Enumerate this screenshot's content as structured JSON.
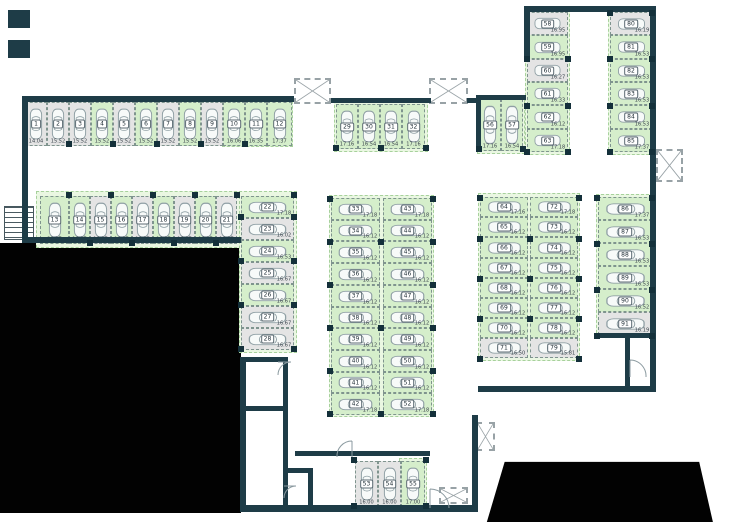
{
  "plan": {
    "name": "underground-parking-floor-plan",
    "stall_states": {
      "green": "highlighted available stall",
      "grey": "plain stall"
    }
  },
  "colors": {
    "wall": "#1e3c47",
    "stall_green": "#d5eecb",
    "stall_grey": "#e4e4e4",
    "zone_green": "#eaf7e2",
    "void": "#020202"
  },
  "stalls": [
    {
      "n": "1",
      "a": "14.04",
      "st": "grey",
      "x": 25,
      "y": 102,
      "w": 22,
      "h": 44,
      "o": "v"
    },
    {
      "n": "2",
      "a": "15.52",
      "st": "grey",
      "x": 47,
      "y": 102,
      "w": 22,
      "h": 44,
      "o": "v"
    },
    {
      "n": "3",
      "a": "15.52",
      "st": "grey",
      "x": 69,
      "y": 102,
      "w": 22,
      "h": 44,
      "o": "v"
    },
    {
      "n": "4",
      "a": "15.52",
      "st": "green",
      "x": 91,
      "y": 102,
      "w": 22,
      "h": 44,
      "o": "v"
    },
    {
      "n": "5",
      "a": "15.52",
      "st": "grey",
      "x": 113,
      "y": 102,
      "w": 22,
      "h": 44,
      "o": "v"
    },
    {
      "n": "6",
      "a": "15.52",
      "st": "green",
      "x": 135,
      "y": 102,
      "w": 22,
      "h": 44,
      "o": "v"
    },
    {
      "n": "7",
      "a": "15.52",
      "st": "grey",
      "x": 157,
      "y": 102,
      "w": 22,
      "h": 44,
      "o": "v"
    },
    {
      "n": "8",
      "a": "15.52",
      "st": "green",
      "x": 179,
      "y": 102,
      "w": 22,
      "h": 44,
      "o": "v"
    },
    {
      "n": "9",
      "a": "15.52",
      "st": "grey",
      "x": 201,
      "y": 102,
      "w": 22,
      "h": 44,
      "o": "v"
    },
    {
      "n": "10",
      "a": "16.06",
      "st": "green",
      "x": 223,
      "y": 102,
      "w": 22,
      "h": 44,
      "o": "v"
    },
    {
      "n": "11",
      "a": "16.35",
      "st": "green",
      "x": 245,
      "y": 102,
      "w": 22,
      "h": 44,
      "o": "v"
    },
    {
      "n": "12",
      "a": "17.37",
      "st": "green",
      "x": 267,
      "y": 102,
      "w": 25,
      "h": 44,
      "o": "v"
    },
    {
      "n": "13",
      "a": "20.27",
      "st": "green",
      "x": 40,
      "y": 196,
      "w": 29,
      "h": 48,
      "o": "v"
    },
    {
      "n": "14",
      "a": "16.87",
      "st": "green",
      "x": 69,
      "y": 196,
      "w": 21,
      "h": 48,
      "o": "v"
    },
    {
      "n": "15",
      "a": "16.87",
      "st": "grey",
      "x": 90,
      "y": 196,
      "w": 21,
      "h": 48,
      "o": "v"
    },
    {
      "n": "16",
      "a": "16.87",
      "st": "green",
      "x": 111,
      "y": 196,
      "w": 21,
      "h": 48,
      "o": "v"
    },
    {
      "n": "17",
      "a": "16.87",
      "st": "grey",
      "x": 132,
      "y": 196,
      "w": 21,
      "h": 48,
      "o": "v"
    },
    {
      "n": "18",
      "a": "16.87",
      "st": "green",
      "x": 153,
      "y": 196,
      "w": 21,
      "h": 48,
      "o": "v"
    },
    {
      "n": "19",
      "a": "16.87",
      "st": "grey",
      "x": 174,
      "y": 196,
      "w": 21,
      "h": 48,
      "o": "v"
    },
    {
      "n": "20",
      "a": "16.87",
      "st": "green",
      "x": 195,
      "y": 196,
      "w": 21,
      "h": 48,
      "o": "v"
    },
    {
      "n": "21",
      "a": "16.87",
      "st": "grey",
      "x": 216,
      "y": 196,
      "w": 21,
      "h": 48,
      "o": "v"
    },
    {
      "n": "22",
      "a": "17.18",
      "st": "green",
      "x": 241,
      "y": 196,
      "w": 53,
      "h": 22,
      "o": "h"
    },
    {
      "n": "23",
      "a": "16.02",
      "st": "grey",
      "x": 241,
      "y": 218,
      "w": 53,
      "h": 22,
      "o": "h"
    },
    {
      "n": "24",
      "a": "16.53",
      "st": "green",
      "x": 241,
      "y": 240,
      "w": 53,
      "h": 22,
      "o": "h"
    },
    {
      "n": "25",
      "a": "16.67",
      "st": "grey",
      "x": 241,
      "y": 262,
      "w": 53,
      "h": 22,
      "o": "h"
    },
    {
      "n": "26",
      "a": "16.67",
      "st": "green",
      "x": 241,
      "y": 284,
      "w": 53,
      "h": 22,
      "o": "h"
    },
    {
      "n": "27",
      "a": "16.67",
      "st": "grey",
      "x": 241,
      "y": 306,
      "w": 53,
      "h": 22,
      "o": "h"
    },
    {
      "n": "28",
      "a": "16.67",
      "st": "grey",
      "x": 241,
      "y": 328,
      "w": 53,
      "h": 22,
      "o": "h"
    },
    {
      "n": "29",
      "a": "17.16",
      "st": "green",
      "x": 336,
      "y": 104,
      "w": 22,
      "h": 45,
      "o": "v"
    },
    {
      "n": "30",
      "a": "16.54",
      "st": "green",
      "x": 358,
      "y": 104,
      "w": 22,
      "h": 45,
      "o": "v"
    },
    {
      "n": "31",
      "a": "16.54",
      "st": "green",
      "x": 380,
      "y": 104,
      "w": 22,
      "h": 45,
      "o": "v"
    },
    {
      "n": "32",
      "a": "17.16",
      "st": "green",
      "x": 402,
      "y": 104,
      "w": 23,
      "h": 45,
      "o": "v"
    },
    {
      "n": "33",
      "a": "17.18",
      "st": "green",
      "x": 331,
      "y": 198,
      "w": 49,
      "h": 22,
      "o": "h"
    },
    {
      "n": "34",
      "a": "16.12",
      "st": "green",
      "x": 331,
      "y": 220,
      "w": 49,
      "h": 21,
      "o": "h"
    },
    {
      "n": "35",
      "a": "16.12",
      "st": "green",
      "x": 331,
      "y": 241,
      "w": 49,
      "h": 22,
      "o": "h"
    },
    {
      "n": "36",
      "a": "16.12",
      "st": "green",
      "x": 331,
      "y": 263,
      "w": 49,
      "h": 22,
      "o": "h"
    },
    {
      "n": "37",
      "a": "16.12",
      "st": "green",
      "x": 331,
      "y": 285,
      "w": 49,
      "h": 22,
      "o": "h"
    },
    {
      "n": "38",
      "a": "16.12",
      "st": "green",
      "x": 331,
      "y": 307,
      "w": 49,
      "h": 21,
      "o": "h"
    },
    {
      "n": "39",
      "a": "16.12",
      "st": "green",
      "x": 331,
      "y": 328,
      "w": 49,
      "h": 22,
      "o": "h"
    },
    {
      "n": "40",
      "a": "16.12",
      "st": "green",
      "x": 331,
      "y": 350,
      "w": 49,
      "h": 22,
      "o": "h"
    },
    {
      "n": "41",
      "a": "16.12",
      "st": "green",
      "x": 331,
      "y": 372,
      "w": 49,
      "h": 21,
      "o": "h"
    },
    {
      "n": "42",
      "a": "17.18",
      "st": "green",
      "x": 331,
      "y": 393,
      "w": 49,
      "h": 22,
      "o": "h"
    },
    {
      "n": "43",
      "a": "17.18",
      "st": "green",
      "x": 383,
      "y": 198,
      "w": 49,
      "h": 22,
      "o": "h"
    },
    {
      "n": "44",
      "a": "16.12",
      "st": "green",
      "x": 383,
      "y": 220,
      "w": 49,
      "h": 21,
      "o": "h"
    },
    {
      "n": "45",
      "a": "16.12",
      "st": "green",
      "x": 383,
      "y": 241,
      "w": 49,
      "h": 22,
      "o": "h"
    },
    {
      "n": "46",
      "a": "16.12",
      "st": "green",
      "x": 383,
      "y": 263,
      "w": 49,
      "h": 22,
      "o": "h"
    },
    {
      "n": "47",
      "a": "16.12",
      "st": "green",
      "x": 383,
      "y": 285,
      "w": 49,
      "h": 22,
      "o": "h"
    },
    {
      "n": "48",
      "a": "16.12",
      "st": "green",
      "x": 383,
      "y": 307,
      "w": 49,
      "h": 21,
      "o": "h"
    },
    {
      "n": "49",
      "a": "16.12",
      "st": "green",
      "x": 383,
      "y": 328,
      "w": 49,
      "h": 22,
      "o": "h"
    },
    {
      "n": "50",
      "a": "16.12",
      "st": "green",
      "x": 383,
      "y": 350,
      "w": 49,
      "h": 22,
      "o": "h"
    },
    {
      "n": "51",
      "a": "16.12",
      "st": "green",
      "x": 383,
      "y": 372,
      "w": 49,
      "h": 21,
      "o": "h"
    },
    {
      "n": "52",
      "a": "17.18",
      "st": "green",
      "x": 383,
      "y": 393,
      "w": 49,
      "h": 22,
      "o": "h"
    },
    {
      "n": "53",
      "a": "16.00",
      "st": "grey",
      "x": 355,
      "y": 461,
      "w": 23,
      "h": 46,
      "o": "v"
    },
    {
      "n": "54",
      "a": "16.00",
      "st": "grey",
      "x": 378,
      "y": 461,
      "w": 23,
      "h": 46,
      "o": "v"
    },
    {
      "n": "55",
      "a": "17.00",
      "st": "green",
      "x": 401,
      "y": 461,
      "w": 24,
      "h": 46,
      "o": "v"
    },
    {
      "n": "56",
      "a": "17.16",
      "st": "green",
      "x": 479,
      "y": 99,
      "w": 22,
      "h": 52,
      "o": "v"
    },
    {
      "n": "57",
      "a": "16.54",
      "st": "green",
      "x": 501,
      "y": 99,
      "w": 22,
      "h": 52,
      "o": "v"
    },
    {
      "n": "58",
      "a": "16.95",
      "st": "grey",
      "x": 527,
      "y": 12,
      "w": 41,
      "h": 23,
      "o": "h"
    },
    {
      "n": "59",
      "a": "16.95",
      "st": "green",
      "x": 527,
      "y": 35,
      "w": 41,
      "h": 24,
      "o": "h"
    },
    {
      "n": "60",
      "a": "16.27",
      "st": "grey",
      "x": 527,
      "y": 59,
      "w": 41,
      "h": 23,
      "o": "h"
    },
    {
      "n": "61",
      "a": "16.33",
      "st": "green",
      "x": 527,
      "y": 82,
      "w": 41,
      "h": 23,
      "o": "h"
    },
    {
      "n": "62",
      "a": "16.12",
      "st": "green",
      "x": 527,
      "y": 105,
      "w": 41,
      "h": 24,
      "o": "h"
    },
    {
      "n": "63",
      "a": "17.18",
      "st": "green",
      "x": 527,
      "y": 129,
      "w": 41,
      "h": 23,
      "o": "h"
    },
    {
      "n": "64",
      "a": "17.16",
      "st": "green",
      "x": 480,
      "y": 197,
      "w": 48,
      "h": 20,
      "o": "h"
    },
    {
      "n": "65",
      "a": "16.12",
      "st": "green",
      "x": 480,
      "y": 217,
      "w": 48,
      "h": 20,
      "o": "h"
    },
    {
      "n": "66",
      "a": "16.12",
      "st": "green",
      "x": 480,
      "y": 237,
      "w": 48,
      "h": 21,
      "o": "h"
    },
    {
      "n": "67",
      "a": "16.12",
      "st": "green",
      "x": 480,
      "y": 258,
      "w": 48,
      "h": 20,
      "o": "h"
    },
    {
      "n": "68",
      "a": "16.12",
      "st": "green",
      "x": 480,
      "y": 278,
      "w": 48,
      "h": 20,
      "o": "h"
    },
    {
      "n": "69",
      "a": "16.12",
      "st": "green",
      "x": 480,
      "y": 298,
      "w": 48,
      "h": 20,
      "o": "h"
    },
    {
      "n": "70",
      "a": "16.12",
      "st": "green",
      "x": 480,
      "y": 318,
      "w": 48,
      "h": 20,
      "o": "h"
    },
    {
      "n": "71",
      "a": "16.50",
      "st": "grey",
      "x": 480,
      "y": 338,
      "w": 48,
      "h": 20,
      "o": "h"
    },
    {
      "n": "72",
      "a": "17.18",
      "st": "green",
      "x": 530,
      "y": 197,
      "w": 48,
      "h": 20,
      "o": "h"
    },
    {
      "n": "73",
      "a": "16.12",
      "st": "green",
      "x": 530,
      "y": 217,
      "w": 48,
      "h": 20,
      "o": "h"
    },
    {
      "n": "74",
      "a": "16.12",
      "st": "green",
      "x": 530,
      "y": 237,
      "w": 48,
      "h": 21,
      "o": "h"
    },
    {
      "n": "75",
      "a": "16.12",
      "st": "green",
      "x": 530,
      "y": 258,
      "w": 48,
      "h": 20,
      "o": "h"
    },
    {
      "n": "76",
      "a": "16.12",
      "st": "green",
      "x": 530,
      "y": 278,
      "w": 48,
      "h": 20,
      "o": "h"
    },
    {
      "n": "77",
      "a": "16.12",
      "st": "green",
      "x": 530,
      "y": 298,
      "w": 48,
      "h": 20,
      "o": "h"
    },
    {
      "n": "78",
      "a": "16.12",
      "st": "green",
      "x": 530,
      "y": 318,
      "w": 48,
      "h": 20,
      "o": "h"
    },
    {
      "n": "79",
      "a": "15.81",
      "st": "grey",
      "x": 530,
      "y": 338,
      "w": 48,
      "h": 20,
      "o": "h"
    },
    {
      "n": "80",
      "a": "16.19",
      "st": "grey",
      "x": 610,
      "y": 12,
      "w": 42,
      "h": 23,
      "o": "h"
    },
    {
      "n": "81",
      "a": "16.53",
      "st": "green",
      "x": 610,
      "y": 35,
      "w": 42,
      "h": 24,
      "o": "h"
    },
    {
      "n": "82",
      "a": "16.53",
      "st": "green",
      "x": 610,
      "y": 59,
      "w": 42,
      "h": 23,
      "o": "h"
    },
    {
      "n": "83",
      "a": "16.53",
      "st": "green",
      "x": 610,
      "y": 82,
      "w": 42,
      "h": 23,
      "o": "h"
    },
    {
      "n": "84",
      "a": "16.53",
      "st": "green",
      "x": 610,
      "y": 105,
      "w": 42,
      "h": 24,
      "o": "h"
    },
    {
      "n": "85",
      "a": "17.37",
      "st": "green",
      "x": 610,
      "y": 129,
      "w": 42,
      "h": 23,
      "o": "h"
    },
    {
      "n": "86",
      "a": "17.37",
      "st": "green",
      "x": 598,
      "y": 197,
      "w": 54,
      "h": 23,
      "o": "h"
    },
    {
      "n": "87",
      "a": "16.53",
      "st": "green",
      "x": 598,
      "y": 220,
      "w": 54,
      "h": 23,
      "o": "h"
    },
    {
      "n": "88",
      "a": "16.53",
      "st": "green",
      "x": 598,
      "y": 243,
      "w": 54,
      "h": 23,
      "o": "h"
    },
    {
      "n": "89",
      "a": "16.53",
      "st": "green",
      "x": 598,
      "y": 266,
      "w": 54,
      "h": 23,
      "o": "h"
    },
    {
      "n": "90",
      "a": "16.52",
      "st": "green",
      "x": 598,
      "y": 289,
      "w": 54,
      "h": 23,
      "o": "h"
    },
    {
      "n": "91",
      "a": "16.19",
      "st": "grey",
      "x": 598,
      "y": 312,
      "w": 54,
      "h": 23,
      "o": "h"
    }
  ]
}
